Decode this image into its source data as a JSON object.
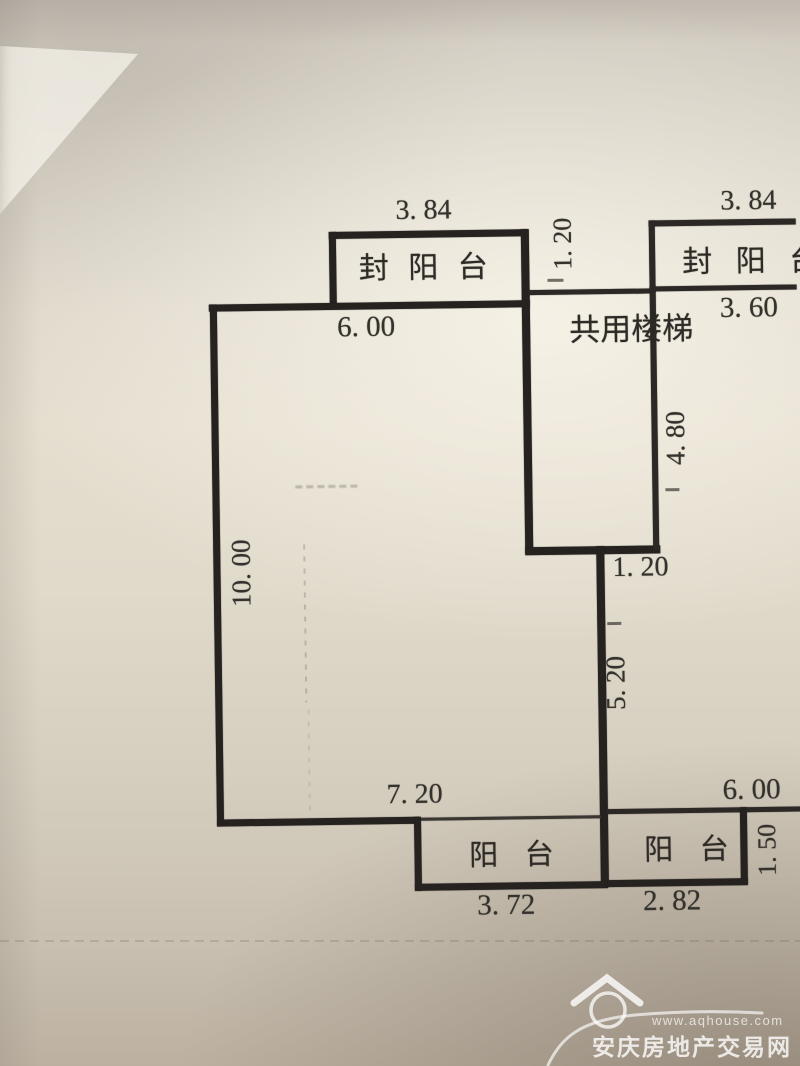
{
  "floorplan": {
    "unit_labels": {
      "balcony_top_left": "封 阳 台",
      "balcony_top_right": "封 阳 台",
      "shared_stair": "共用楼梯",
      "balcony_bottom_left": "阳  台",
      "balcony_bottom_right": "阳  台"
    },
    "dimensions": {
      "top_left_width": "3. 84",
      "top_gap": "1. 20",
      "top_right_width": "3. 84",
      "main_top_width": "6. 00",
      "right_top_width": "3. 60",
      "stair_height": "4. 80",
      "left_height": "10. 00",
      "mid_offset": "1. 20",
      "lower_right_height": "5. 20",
      "main_bottom_width": "7. 20",
      "right_bottom_width": "6. 00",
      "balcony_bl_width": "3. 72",
      "balcony_br_width": "2. 82",
      "balcony_br_depth": "1. 50"
    },
    "colors": {
      "ink": "#252220",
      "paper_light": "#e4decf",
      "paper_dark": "#bcb1a1",
      "watermark": "#ffffff"
    }
  },
  "watermark": {
    "url": "www.aqhouse.com",
    "site_name": "安庆房地产交易网",
    "icon": "house-icon"
  }
}
